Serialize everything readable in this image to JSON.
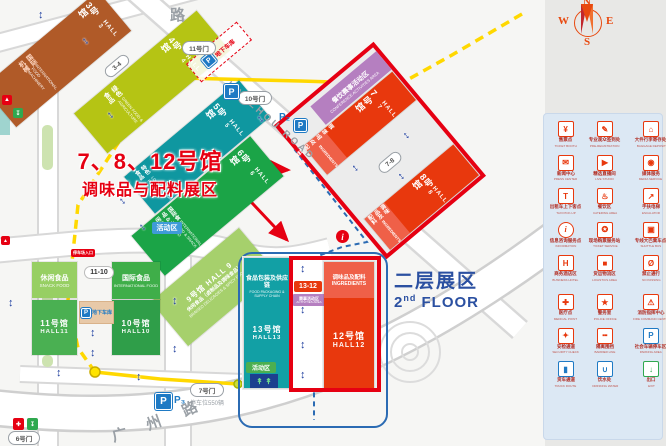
{
  "title": {
    "line1": "7、8、12号馆",
    "line2": "调味品与配料展区"
  },
  "second_floor": {
    "cn": "二层展区",
    "num": "2",
    "sup": "nd",
    "rest": " FLOOR"
  },
  "compass": {
    "n": "N",
    "e": "E",
    "s": "S",
    "w": "W"
  },
  "roads": {
    "top_char": "路",
    "hanzhou": "HANZHOU ROAD",
    "guangzhou": [
      "广",
      "州",
      "路"
    ]
  },
  "gates": {
    "g11": "11号门",
    "g10": "10号门",
    "g7": "7号门",
    "g6": "6号门",
    "g34": "3-4",
    "g78": "7-8",
    "g1110": "11-10",
    "g1312": "13-12"
  },
  "halls": {
    "h3": {
      "name": "3号馆",
      "hall": "HALL 3",
      "sub_cn": "国际机械",
      "sub_en": "INTERNATIONAL FOOD MACHINERY",
      "color": "#b05a28"
    },
    "h4": {
      "name": "4号馆",
      "hall": "HALL 4",
      "sub_cn": "绿色食品",
      "sub_en": "GREEN FOOD & AGRICULTURE",
      "color": "#b5c414"
    },
    "h5": {
      "name": "5号馆",
      "hall": "HALL 5",
      "sub_cn": "特色食品",
      "sub_en": "LOCAL FLAVOR FOODS",
      "color": "#0f97a0"
    },
    "h6": {
      "name": "6号馆",
      "hall": "HALL 6",
      "sub_cn": "国际食品 & 休闲食品",
      "sub_en": "INTERNATIONAL FOOD & SNACK FOOD",
      "color": "#1ba447"
    },
    "h7": {
      "name": "7号馆",
      "hall": "HALL 7",
      "strip_cn": "调味品及配料",
      "strip_en": "INGREDIENTS",
      "color": "#e8380d"
    },
    "h8": {
      "name": "8号馆",
      "hall": "HALL 8",
      "strip_cn": "调味品及配料",
      "strip_en": "INGREDIENTS",
      "color": "#e8380d"
    },
    "h9": {
      "name": "9号馆",
      "hall": "HALL 9",
      "sub_cn": "休闲食品（卤制品及调味食品）",
      "sub_en": "BRAISED DELICACIES & SPICY FOODS",
      "color": "#a6d06c"
    },
    "h10": {
      "name": "10号馆",
      "hall": "HALL10",
      "color": "#2f9e49"
    },
    "h11": {
      "name": "11号馆",
      "hall": "HALL11",
      "color": "#4ab052"
    },
    "h12": {
      "name": "12号馆",
      "hall": "HALL12",
      "strip_cn": "调味品及配料",
      "strip_en": "INGREDIENTS",
      "color": "#e8380d"
    },
    "h13": {
      "name": "13号馆",
      "hall": "HALL13",
      "color": "#12a0a5"
    },
    "snack": {
      "cn": "休闲食品",
      "en": "SNACK FOOD",
      "color": "#97cf63"
    },
    "intl": {
      "cn": "国际食品",
      "en": "INTERNATIONAL FOOD",
      "color": "#3fae49"
    },
    "pack": {
      "cn": "食品包装及供应链",
      "en": "FOOD PACKAGING & SUPPLY CHAIN"
    }
  },
  "areas": {
    "conference": {
      "cn": "餐饮赛事活动区",
      "en": "CONFERENCE ACTIVITIES AREA",
      "color": "#b57fc0"
    },
    "activities_mini": {
      "cn": "赛事活动区",
      "en": "ACTIVITIES AREA"
    },
    "activity_badge_blue": "活动区",
    "activity_badge_green": "活动区",
    "parking_entrance_badge": "停车场入口"
  },
  "parking": {
    "p": "P",
    "p2": "P₂",
    "p3": "P₃",
    "p3_note": "停车位550辆",
    "underground": "地下车库"
  },
  "info_icon": "i",
  "legend": {
    "items": [
      {
        "cn": "售票点",
        "en": "TICKET BOOTH",
        "glyph": "¥",
        "color": "#e8380d"
      },
      {
        "cn": "专业观众签到处",
        "en": "PRE-REGISTRATION",
        "glyph": "✎",
        "color": "#e8380d"
      },
      {
        "cn": "大件行李寄存处",
        "en": "BAGGAGE DEPOSIT",
        "glyph": "⌂",
        "color": "#e8380d"
      },
      {
        "cn": "观众登记咨询口",
        "en": "VISITOR REGISTRATION",
        "glyph": "≡",
        "color": "#e8380d"
      },
      {
        "cn": "新闻中心",
        "en": "PRESS CENTER",
        "glyph": "✉",
        "color": "#e8380d"
      },
      {
        "cn": "精选直播间",
        "en": "LIVE STUDIO",
        "glyph": "▶",
        "color": "#e8380d"
      },
      {
        "cn": "媒体服务",
        "en": "MEDIA SERVICE",
        "glyph": "◉",
        "color": "#e8380d"
      },
      {
        "cn": "论坛活动区",
        "en": "FORUM & ACTIVITY AREA",
        "glyph": "♦",
        "color": "#e8380d"
      },
      {
        "cn": "出租车上下客点",
        "en": "TAXI PICK-UP",
        "glyph": "T",
        "color": "#e8380d"
      },
      {
        "cn": "餐饮区",
        "en": "CATERING AREA",
        "glyph": "♨",
        "color": "#e8380d"
      },
      {
        "cn": "手扶电梯",
        "en": "ESCALATOR",
        "glyph": "↗",
        "color": "#e8380d"
      },
      {
        "cn": "观展休息区·洽谈区",
        "en": "REST & LOUNGE AREA",
        "glyph": "❖",
        "color": "#e8380d"
      },
      {
        "cn": "信息咨询服务点",
        "en": "INFORMATION",
        "glyph": "i",
        "color": "#e8380d"
      },
      {
        "cn": "现场购票服务站",
        "en": "TICKET SERVICE",
        "glyph": "✪",
        "color": "#e8380d"
      },
      {
        "cn": "专线大巴乘车点",
        "en": "SHUTTLE BUS",
        "glyph": "▣",
        "color": "#e8380d"
      },
      {
        "cn": "公交乘车点",
        "en": "PUBLIC BUS STOP",
        "glyph": "□",
        "color": "#e8380d"
      },
      {
        "cn": "商务酒店区",
        "en": "BUSINESS HOTEL",
        "glyph": "H",
        "color": "#e8380d"
      },
      {
        "cn": "货运物流区",
        "en": "LOGISTICS AREA",
        "glyph": "■",
        "color": "#e8380d"
      },
      {
        "cn": "禁止通行",
        "en": "NO PASSING",
        "glyph": "Ø",
        "color": "#e8380d"
      },
      {
        "cn": "组委会办公区·会议服务中心",
        "en": "COMMITTEE OFFICE",
        "glyph": "⚑",
        "color": "#e8380d"
      },
      {
        "cn": "医疗点",
        "en": "MEDICAL POINT",
        "glyph": "✚",
        "color": "#e8380d"
      },
      {
        "cn": "警务室",
        "en": "POLICE OFFICE",
        "glyph": "★",
        "color": "#e8380d"
      },
      {
        "cn": "消防指挥中心",
        "en": "FIRE COMMAND CENTER",
        "glyph": "⚠",
        "color": "#e8380d"
      },
      {
        "cn": "ATM取款机",
        "en": "ATM",
        "glyph": "¤",
        "color": "#e8380d"
      },
      {
        "cn": "安检通道",
        "en": "SECURITY CHECK",
        "glyph": "✦",
        "color": "#e8380d"
      },
      {
        "cn": "隔离围挡",
        "en": "BARRIER LINE",
        "glyph": "╍",
        "color": "#e8380d"
      },
      {
        "cn": "社会车辆停车区",
        "en": "PARKING AREA",
        "glyph": "P",
        "color": "#1f7ac4"
      },
      {
        "cn": "地铁1号线",
        "en": "METRO LINE 1",
        "glyph": "≈",
        "color": "#1f7ac4"
      },
      {
        "cn": "货车通道",
        "en": "TRUCK ROUTE",
        "glyph": "▮",
        "color": "#1f7ac4"
      },
      {
        "cn": "饮水处",
        "en": "DRINKING WATER",
        "glyph": "∪",
        "color": "#1f7ac4"
      },
      {
        "cn": "出口",
        "en": "EXIT",
        "glyph": "↓",
        "color": "#2fa84f"
      }
    ]
  },
  "colors": {
    "accent_red": "#e60012",
    "hall_red": "#e8380d",
    "route_yellow": "#ffd800",
    "route_blue": "#2b6bb3",
    "floor2_blue": "#2b50a1",
    "legend_bg": "#dce8f4"
  }
}
